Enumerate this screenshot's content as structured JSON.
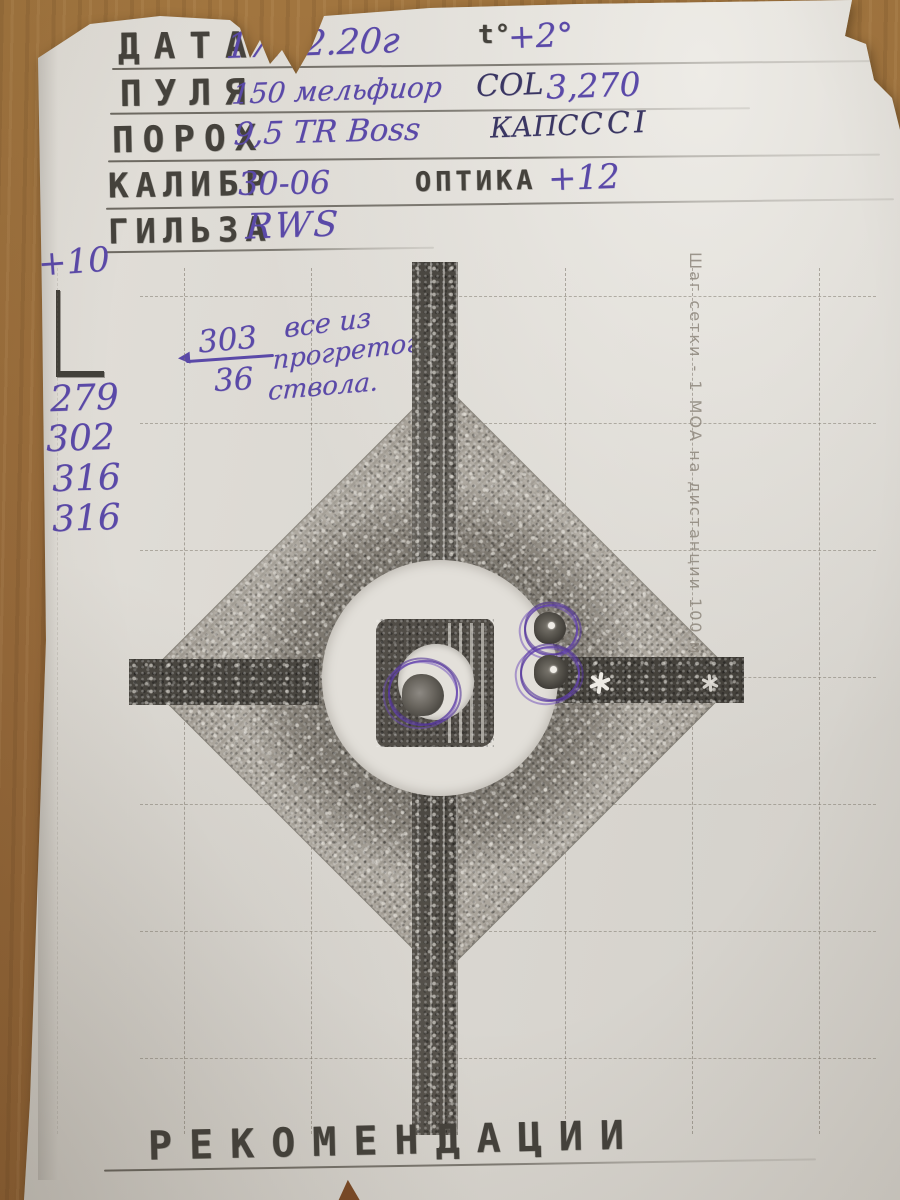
{
  "form": {
    "rows": [
      {
        "label": "ДАТА",
        "value": "17.02.20г",
        "label2": "t°",
        "value2": "+2°"
      },
      {
        "label": "ПУЛЯ",
        "value": "150 мельфиор",
        "label2": "COL",
        "value2": "3,270"
      },
      {
        "label": "ПОРОХ",
        "value": "9,5 TR Boss",
        "label2": "КАПС",
        "value2": "CCI"
      },
      {
        "label": "КАЛИБР",
        "value": "30-06",
        "label2": "ОПТИКА",
        "value2": "+12"
      },
      {
        "label": "ГИЛЬЗА",
        "value": "RWS",
        "label2": "",
        "value2": ""
      }
    ],
    "footer": "РЕКОМЕНДАЦИИ"
  },
  "notes": {
    "elevation": "+10",
    "shots": [
      "279",
      "302",
      "316",
      "316"
    ],
    "frac_num": "303",
    "frac_den": "36",
    "warm": [
      "все из",
      "прогретого",
      "ствола."
    ]
  },
  "target": {
    "caption": "Шаг сетки - 1 МОА на дистанции 100 м"
  },
  "colors": {
    "ink_purple": "#5a49a8",
    "ink_dark": "#3a3663",
    "stamp_grey": "#45423c",
    "paper": "#dbd8d2",
    "wood": "#9c7040"
  }
}
